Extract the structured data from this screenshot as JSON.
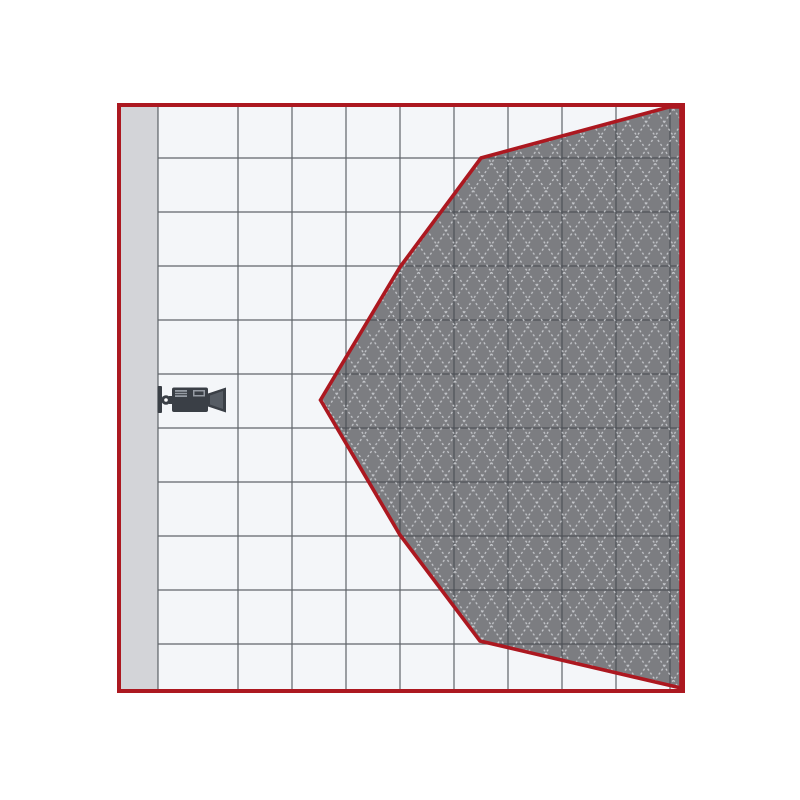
{
  "diagram": {
    "name": "camera-field-of-view-diagram",
    "canvas": {
      "width": 800,
      "height": 800,
      "background": "#ffffff"
    },
    "frame": {
      "x": 119,
      "y": 105,
      "width": 564,
      "height": 586,
      "border_color": "#ac1820",
      "border_width": 4,
      "inner_background": "#f4f6f9"
    },
    "wall_strip": {
      "x": 121,
      "y": 107,
      "width": 37,
      "height": 582,
      "color": "#d3d4d8"
    },
    "grid": {
      "line_color": "#474b52",
      "line_width": 1.2,
      "line_opacity": 0.85,
      "vertical_x": [
        158,
        238,
        292,
        346,
        400,
        454,
        508,
        562,
        616,
        670
      ],
      "horizontal_y": [
        158,
        212,
        266,
        320,
        374,
        428,
        482,
        536,
        590,
        644
      ],
      "x_start": 158,
      "x_end": 681,
      "y_start": 107,
      "y_end": 689
    },
    "coverage_area": {
      "fill": "#7c7d81",
      "outline_color": "#ac1820",
      "outline_width": 3.6,
      "hatch_color": "#ced0d4",
      "hatch_cell_width": 18.2,
      "hatch_cell_height": 27.2,
      "points": [
        [
          320.5,
          400
        ],
        [
          400,
          267
        ],
        [
          481,
          158
        ],
        [
          669,
          107
        ],
        [
          681,
          107
        ],
        [
          681,
          688
        ],
        [
          480,
          641
        ],
        [
          400,
          535
        ]
      ]
    },
    "camera": {
      "icon": "video-camera-icon",
      "body_color": "#3a3f46",
      "detail_color": "#959ba3",
      "inner_color": "#565c64",
      "origin_x": 157,
      "origin_y": 385
    }
  }
}
